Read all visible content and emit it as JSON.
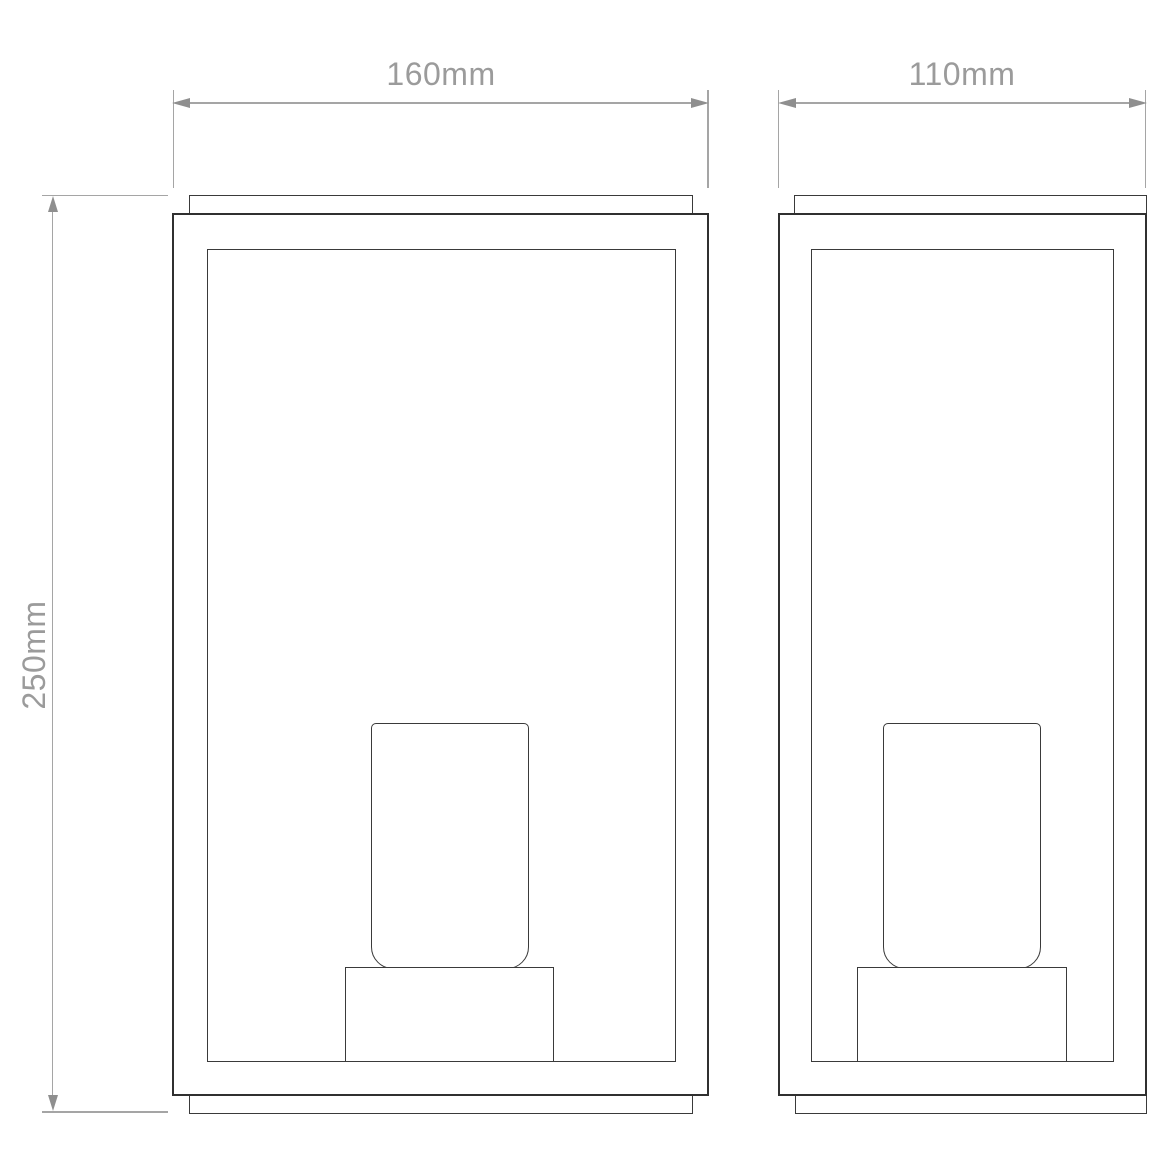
{
  "dimensions": {
    "front_width": {
      "label": "160mm"
    },
    "side_depth": {
      "label": "110mm"
    },
    "height": {
      "label": "250mm"
    }
  },
  "colors": {
    "background": "#ffffff",
    "drawing_line": "#3a3a3a",
    "drawing_line_dark": "#303030",
    "dimension_line": "#a5a5a5",
    "dimension_arrow": "#8f8f8f",
    "dimension_text": "#9b9b9b"
  }
}
